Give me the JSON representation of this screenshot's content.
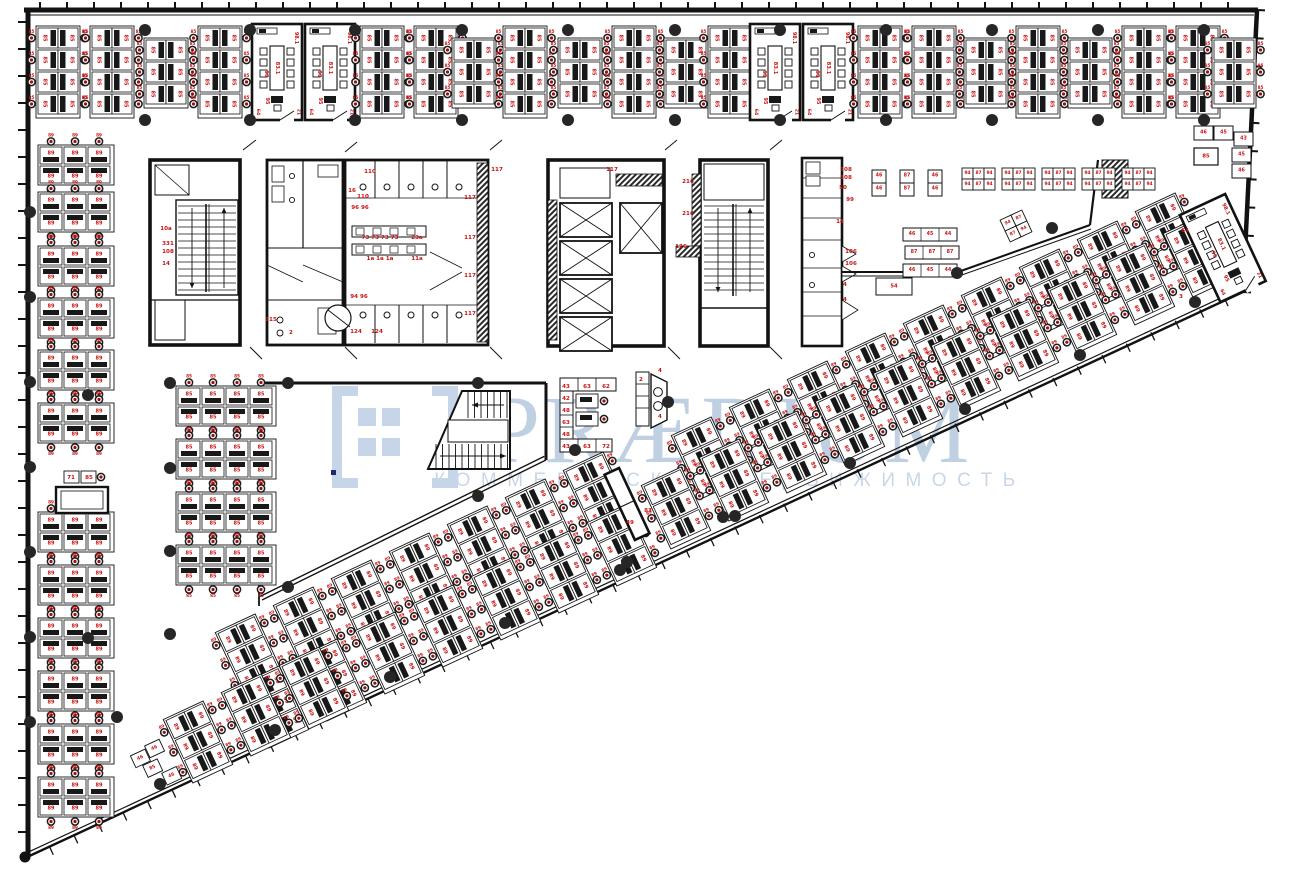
{
  "page": {
    "title": "Office floor plan with workstation layout"
  },
  "watermark": {
    "brand": "PRÆDIUM",
    "subtitle": "КОММЕРЧЕСКАЯ НЕДВИЖИМОСТЬ",
    "color_main": "#bccee2",
    "color_sub": "#c6d5e7",
    "logo_color": "#c4d3e6"
  },
  "colors": {
    "wall": "#121212",
    "label": "#c81414",
    "desk_fill": "#ffffff",
    "pc": "#181818",
    "chair_core": "#9c0f0f",
    "column_dot": "#262626",
    "partition": "#3d3d3d"
  },
  "desk_labels": {
    "top": "85",
    "left": "89",
    "mid": "85",
    "diag": "89"
  },
  "rooms": {
    "cabinet": "98.1",
    "table": "83.1",
    "chairs": "99",
    "desk": "95",
    "corner_l": "64",
    "corner_r": "21"
  },
  "layout": {
    "top_row_y": 26,
    "top_row": [
      [
        36,
        "c4"
      ],
      [
        90,
        "c4"
      ],
      [
        144,
        "c3"
      ],
      [
        198,
        "c4"
      ],
      [
        252,
        "room"
      ],
      [
        305,
        "room"
      ],
      [
        360,
        "c4"
      ],
      [
        414,
        "c4"
      ],
      [
        452,
        "c3"
      ],
      [
        503,
        "c4"
      ],
      [
        558,
        "c3"
      ],
      [
        612,
        "c4"
      ],
      [
        664,
        "c3"
      ],
      [
        708,
        "c4"
      ],
      [
        750,
        "room"
      ],
      [
        803,
        "room"
      ],
      [
        858,
        "c4"
      ],
      [
        912,
        "c4"
      ],
      [
        964,
        "c3"
      ],
      [
        1016,
        "c4"
      ],
      [
        1068,
        "c3"
      ],
      [
        1122,
        "c4"
      ],
      [
        1176,
        "c4"
      ],
      [
        1212,
        "c3"
      ]
    ],
    "left_col_x": 38,
    "left_col_ys": [
      145,
      192,
      246,
      298,
      350,
      403,
      512,
      565,
      618,
      671,
      724,
      777
    ],
    "mid_col_x": 176,
    "mid_col_ys": [
      386,
      439,
      492,
      545
    ],
    "diag_angle": -25,
    "diag_centers": [
      [
        706,
        458
      ],
      [
        764,
        430
      ],
      [
        822,
        402
      ],
      [
        880,
        374
      ],
      [
        938,
        346
      ],
      [
        996,
        318
      ],
      [
        1054,
        290
      ],
      [
        1112,
        262
      ],
      [
        1170,
        234
      ],
      [
        676,
        508
      ],
      [
        734,
        480
      ],
      [
        792,
        452
      ],
      [
        850,
        424
      ],
      [
        908,
        396
      ],
      [
        966,
        368
      ],
      [
        1024,
        340
      ],
      [
        1082,
        312
      ],
      [
        1140,
        284
      ],
      [
        1198,
        256
      ],
      [
        250,
        655
      ],
      [
        308,
        628
      ],
      [
        366,
        601
      ],
      [
        424,
        574
      ],
      [
        482,
        547
      ],
      [
        540,
        520
      ],
      [
        598,
        493
      ],
      [
        274,
        707
      ],
      [
        332,
        680
      ],
      [
        390,
        653
      ],
      [
        448,
        626
      ],
      [
        506,
        599
      ],
      [
        564,
        572
      ],
      [
        622,
        545
      ],
      [
        198,
        742
      ],
      [
        256,
        715
      ],
      [
        314,
        688
      ]
    ],
    "corner_office": {
      "x": 1196,
      "y": 200,
      "cx": 1222,
      "cy": 244
    }
  },
  "kitchen": {
    "pair_y": 170,
    "pair_tables": [
      {
        "x": 872,
        "labels": [
          "46",
          "46"
        ]
      },
      {
        "x": 900,
        "labels": [
          "87",
          "87"
        ]
      },
      {
        "x": 928,
        "labels": [
          "46",
          "46"
        ]
      }
    ],
    "group_y": 168,
    "group_xs": [
      962,
      1002,
      1042,
      1082,
      1122
    ],
    "group_labels": [
      "94",
      "87",
      "94"
    ],
    "counter_rows": [
      {
        "x": 903,
        "y": 228,
        "labels": [
          "46",
          "45",
          "44"
        ]
      },
      {
        "x": 905,
        "y": 246,
        "labels": [
          "87",
          "87",
          "87"
        ]
      },
      {
        "x": 903,
        "y": 264,
        "labels": [
          "46",
          "45",
          "44"
        ]
      }
    ],
    "box54": {
      "x": 876,
      "y": 278,
      "label": "54"
    },
    "tilted": {
      "x": 1004,
      "y": 214,
      "labels": [
        "94",
        "87",
        "87",
        "94"
      ]
    }
  },
  "right_counter": {
    "cells": [
      [
        1194,
        126,
        "46"
      ],
      [
        1214,
        126,
        "45"
      ],
      [
        1234,
        132,
        "43"
      ],
      [
        1232,
        148,
        "45"
      ],
      [
        1232,
        164,
        "46"
      ]
    ],
    "box": [
      1194,
      148,
      "85"
    ]
  },
  "core_labels": [
    [
      166,
      229,
      "10a"
    ],
    [
      168,
      244,
      "331"
    ],
    [
      168,
      252,
      "108"
    ],
    [
      166,
      264,
      "14"
    ],
    [
      370,
      172,
      "110"
    ],
    [
      352,
      191,
      "16"
    ],
    [
      363,
      197,
      "110"
    ],
    [
      360,
      208,
      "96 96"
    ],
    [
      271,
      320,
      "115"
    ],
    [
      291,
      333,
      "2"
    ],
    [
      380,
      238,
      "73 73 73 73"
    ],
    [
      417,
      238,
      "23a"
    ],
    [
      380,
      259,
      "1a 1a 1a"
    ],
    [
      417,
      259,
      "11a"
    ],
    [
      359,
      297,
      "94 96"
    ],
    [
      356,
      332,
      "124"
    ],
    [
      377,
      332,
      "124"
    ],
    [
      470,
      198,
      "117"
    ],
    [
      470,
      238,
      "117"
    ],
    [
      470,
      276,
      "117"
    ],
    [
      470,
      314,
      "117"
    ],
    [
      612,
      170,
      "117"
    ],
    [
      497,
      170,
      "117"
    ],
    [
      688,
      182,
      "216"
    ],
    [
      688,
      214,
      "216"
    ],
    [
      681,
      247,
      "126"
    ],
    [
      846,
      170,
      "108"
    ],
    [
      846,
      178,
      "108"
    ],
    [
      843,
      188,
      "50"
    ],
    [
      850,
      200,
      "99"
    ],
    [
      840,
      222,
      "14"
    ],
    [
      851,
      252,
      "106"
    ],
    [
      851,
      264,
      "106"
    ],
    [
      845,
      285,
      "4"
    ],
    [
      845,
      300,
      "4"
    ]
  ],
  "stray_labels": [
    [
      566,
      387,
      "43"
    ],
    [
      587,
      387,
      "63"
    ],
    [
      606,
      387,
      "62"
    ],
    [
      566,
      399,
      "42"
    ],
    [
      566,
      411,
      "48"
    ],
    [
      566,
      423,
      "63"
    ],
    [
      566,
      435,
      "48"
    ],
    [
      566,
      447,
      "43"
    ],
    [
      587,
      447,
      "63"
    ],
    [
      606,
      447,
      "72"
    ],
    [
      641,
      380,
      "2"
    ],
    [
      660,
      371,
      "4"
    ],
    [
      660,
      417,
      "4"
    ],
    [
      648,
      511,
      "83"
    ],
    [
      630,
      523,
      "49"
    ],
    [
      71,
      478,
      "71"
    ],
    [
      89,
      478,
      "85"
    ],
    [
      1185,
      231,
      "64"
    ],
    [
      1181,
      297,
      "3"
    ]
  ],
  "corner_boxes": [
    "46",
    "46",
    "85",
    "46"
  ],
  "dots": {
    "top_xs": [
      145,
      250,
      355,
      462,
      568,
      675,
      780,
      886,
      992,
      1098,
      1204
    ],
    "top_ys": [
      30,
      120
    ],
    "left_wall_x": 30,
    "left_wall_ys": [
      212,
      297,
      382,
      467,
      552,
      637,
      722
    ],
    "diag": [
      [
        160,
        784
      ],
      [
        275,
        730
      ],
      [
        390,
        677
      ],
      [
        505,
        623
      ],
      [
        620,
        570
      ],
      [
        735,
        516
      ],
      [
        850,
        463
      ],
      [
        965,
        409
      ],
      [
        1080,
        355
      ],
      [
        1195,
        302
      ]
    ],
    "interior": [
      [
        288,
        383
      ],
      [
        478,
        383
      ],
      [
        478,
        496
      ],
      [
        288,
        587
      ],
      [
        575,
        450
      ],
      [
        668,
        402
      ],
      [
        723,
        517
      ],
      [
        627,
        562
      ],
      [
        170,
        383
      ],
      [
        170,
        468
      ],
      [
        170,
        551
      ],
      [
        170,
        634
      ],
      [
        88,
        395
      ],
      [
        88,
        638
      ],
      [
        117,
        717
      ],
      [
        957,
        273
      ],
      [
        1052,
        228
      ]
    ]
  }
}
